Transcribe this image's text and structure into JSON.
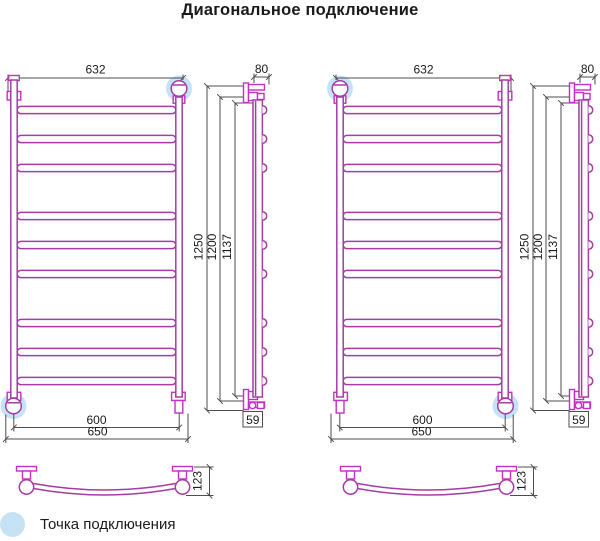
{
  "title": "Диагональное подключение",
  "legend": {
    "label": "Точка подключения",
    "marker": "connection-point-highlight",
    "marker_color": "#c6e3f5"
  },
  "colors": {
    "pipe": "#A43CA4",
    "fitting": "#C42FC4",
    "dimension_lines": "#4d4d4d",
    "text": "#1a1a1a",
    "connection_highlight": "#c6e3f5",
    "background": "#ffffff"
  },
  "drawing": {
    "type": "technical-diagram",
    "subject": "ladder towel radiator — diagonal connection scheme",
    "views": [
      "front",
      "side",
      "bottom-arc"
    ],
    "bar_count": 9,
    "dimensions": {
      "width_top": "632",
      "depth_top": "80",
      "height_overall": "1250",
      "height_axes": "1200",
      "height_inner": "1137",
      "width_axes": "600",
      "width_overall": "650",
      "depth_bottom": "59",
      "arc_depth": "123"
    },
    "diagrams": [
      {
        "name": "variant-1",
        "highlighted_connections": [
          "top-right",
          "bottom-left"
        ]
      },
      {
        "name": "variant-2",
        "highlighted_connections": [
          "top-left",
          "bottom-right"
        ]
      }
    ]
  }
}
